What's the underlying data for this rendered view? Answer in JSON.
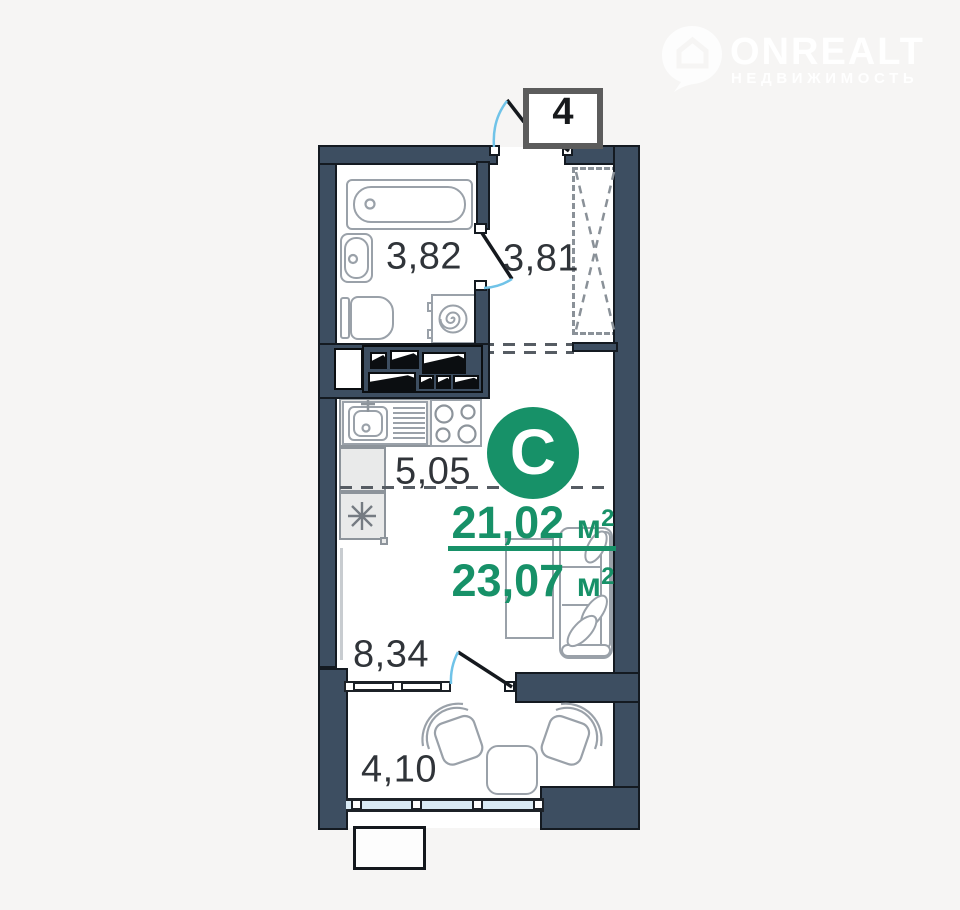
{
  "logo": {
    "brand": "ONREALT",
    "tagline": "НЕДВИЖИМОСТЬ"
  },
  "plan": {
    "unit_number": "4",
    "type_letter": "С",
    "area_upper": "21,02",
    "area_lower": "23,07",
    "unit_base": "м",
    "unit_sup": "2",
    "rooms": {
      "bathroom": "3,82",
      "hallway": "3,81",
      "kitchen": "5,05",
      "living": "8,34",
      "balcony": "4,10"
    }
  },
  "colors": {
    "wall": "#3d4e61",
    "accent_green": "#179168",
    "door_swing_blue": "#70c3e8",
    "window_glass": "#d9eaf5",
    "background": "#f6f5f4"
  }
}
